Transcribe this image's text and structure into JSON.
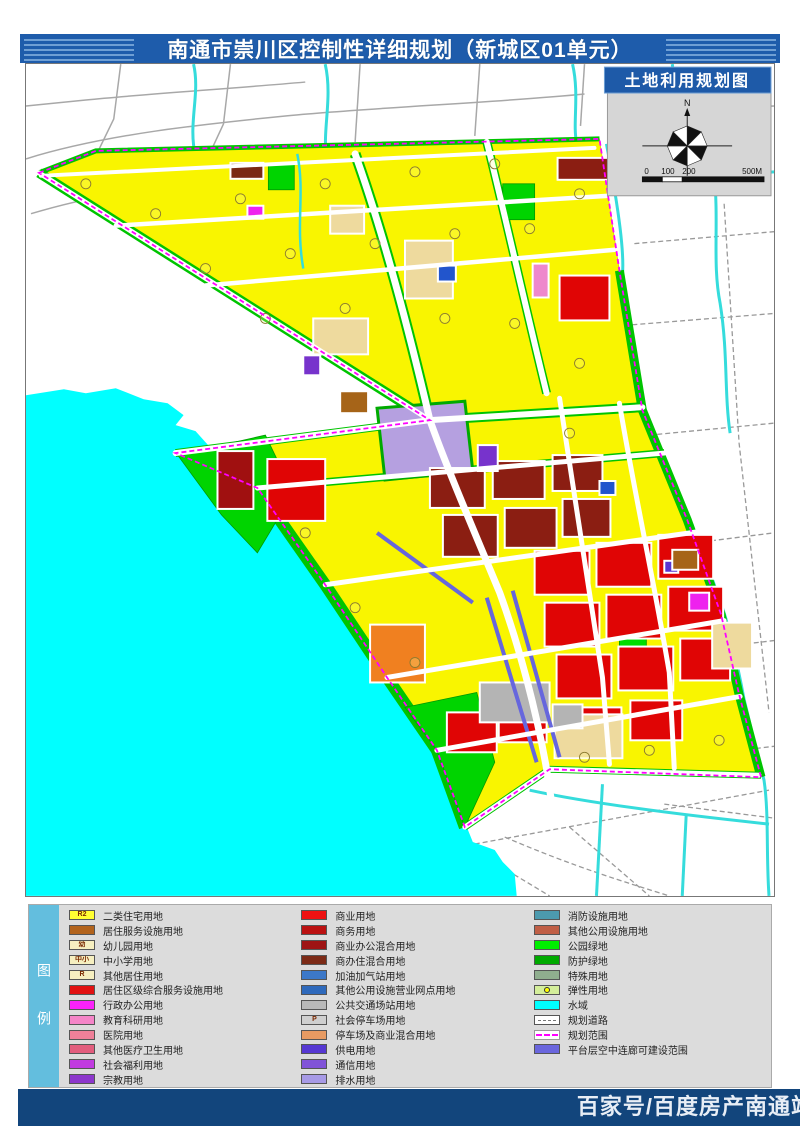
{
  "header": {
    "title": "南通市崇川区控制性详细规划（新城区01单元）"
  },
  "map": {
    "banner_title": "土地利用规划图",
    "north_label": "N",
    "scale_labels": [
      "0",
      "100",
      "200",
      "500M"
    ]
  },
  "legend": {
    "sidebar_label": "图例",
    "columns": [
      [
        {
          "code": "R2",
          "color": "#ffff33",
          "label": "二类住宅用地",
          "swatch": "solid"
        },
        {
          "code": "",
          "color": "#b2631c",
          "label": "居住服务设施用地",
          "swatch": "solid"
        },
        {
          "code": "幼",
          "color": "#f6efc0",
          "label": "幼儿园用地",
          "swatch": "solid"
        },
        {
          "code": "中小",
          "color": "#f6efc0",
          "label": "中小学用地",
          "swatch": "solid"
        },
        {
          "code": "R",
          "color": "#f6efc0",
          "label": "其他居住用地",
          "swatch": "solid"
        },
        {
          "code": "",
          "color": "#e11010",
          "label": "居住区级综合服务设施用地",
          "swatch": "solid"
        },
        {
          "code": "",
          "color": "#fb22fb",
          "label": "行政办公用地",
          "swatch": "solid"
        },
        {
          "code": "",
          "color": "#f585c8",
          "label": "教育科研用地",
          "swatch": "solid"
        },
        {
          "code": "",
          "color": "#ef8099",
          "label": "医院用地",
          "swatch": "solid"
        },
        {
          "code": "",
          "color": "#e25d7d",
          "label": "其他医疗卫生用地",
          "swatch": "solid"
        },
        {
          "code": "",
          "color": "#c13be0",
          "label": "社会福利用地",
          "swatch": "solid"
        },
        {
          "code": "",
          "color": "#8c37cc",
          "label": "宗教用地",
          "swatch": "solid"
        }
      ],
      [
        {
          "code": "",
          "color": "#ee1212",
          "label": "商业用地",
          "swatch": "solid"
        },
        {
          "code": "",
          "color": "#bb1111",
          "label": "商务用地",
          "swatch": "solid"
        },
        {
          "code": "",
          "color": "#9e1414",
          "label": "商业办公混合用地",
          "swatch": "solid"
        },
        {
          "code": "",
          "color": "#7c2a16",
          "label": "商办住混合用地",
          "swatch": "solid"
        },
        {
          "code": "",
          "color": "#3c78c8",
          "label": "加油加气站用地",
          "swatch": "solid"
        },
        {
          "code": "",
          "color": "#2f6abc",
          "label": "其他公用设施营业网点用地",
          "swatch": "solid"
        },
        {
          "code": "",
          "color": "#b9b9b9",
          "label": "公共交通场站用地",
          "swatch": "solid"
        },
        {
          "code": "P",
          "color": "#cfcfcf",
          "label": "社会停车场用地",
          "swatch": "solid"
        },
        {
          "code": "",
          "color": "#e69a62",
          "label": "停车场及商业混合用地",
          "swatch": "solid"
        },
        {
          "code": "",
          "color": "#5638d2",
          "label": "供电用地",
          "swatch": "solid"
        },
        {
          "code": "",
          "color": "#8153d8",
          "label": "通信用地",
          "swatch": "solid"
        },
        {
          "code": "",
          "color": "#a79ae6",
          "label": "排水用地",
          "swatch": "solid"
        }
      ],
      [
        {
          "code": "",
          "color": "#4c9aae",
          "label": "消防设施用地",
          "swatch": "solid"
        },
        {
          "code": "",
          "color": "#c05f46",
          "label": "其他公用设施用地",
          "swatch": "solid"
        },
        {
          "code": "",
          "color": "#00ee00",
          "label": "公园绿地",
          "swatch": "solid"
        },
        {
          "code": "",
          "color": "#00aa00",
          "label": "防护绿地",
          "swatch": "solid"
        },
        {
          "code": "",
          "color": "#8fae8e",
          "label": "特殊用地",
          "swatch": "solid"
        },
        {
          "code": "",
          "color": "#d4ee9a",
          "label": "弹性用地",
          "swatch": "circle"
        },
        {
          "code": "",
          "color": "#00ffff",
          "label": "水域",
          "swatch": "solid"
        },
        {
          "code": "",
          "color": "#ffffff",
          "label": "规划道路",
          "swatch": "road"
        },
        {
          "code": "",
          "color": "#ffffff",
          "label": "规划范围",
          "swatch": "dashline"
        },
        {
          "code": "",
          "color": "#6a66dd",
          "label": "平台层空中连廊可建设范围",
          "swatch": "solid"
        }
      ]
    ]
  },
  "footer": {
    "attribution": "百家号/百度房产南通站"
  }
}
